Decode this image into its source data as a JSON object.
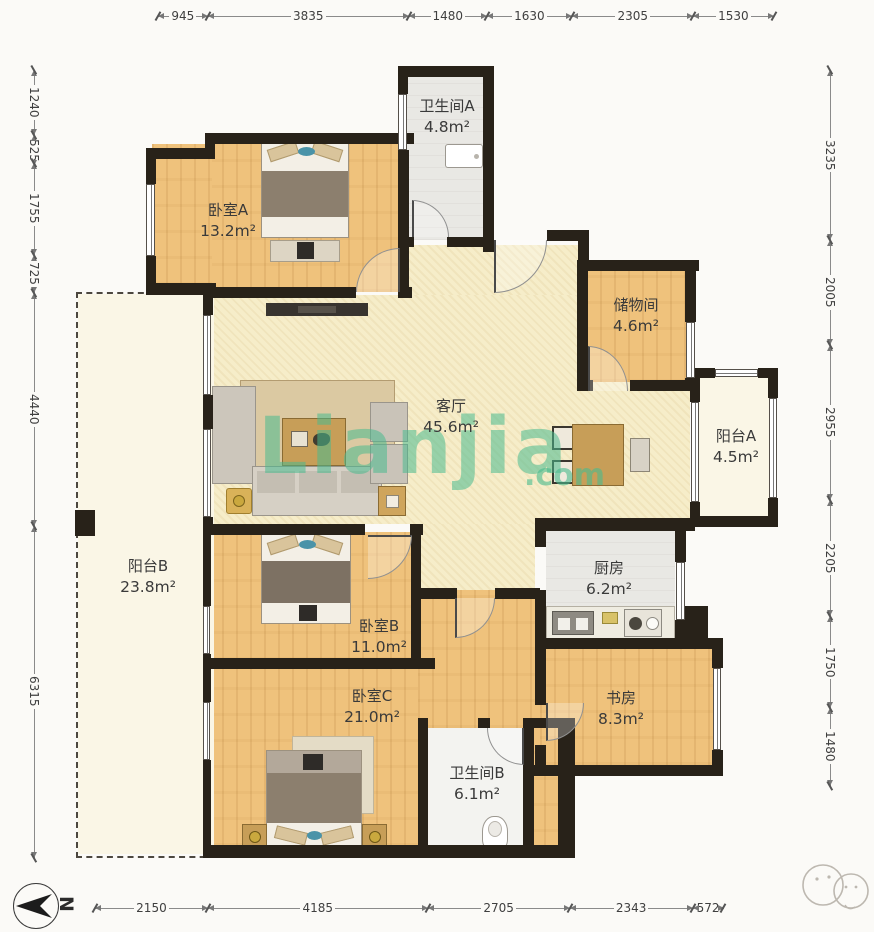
{
  "rooms": [
    {
      "id": "bedroom-a",
      "name": "卧室A",
      "area": "13.2m²"
    },
    {
      "id": "bathroom-a",
      "name": "卫生间A",
      "area": "4.8m²"
    },
    {
      "id": "storage",
      "name": "储物间",
      "area": "4.6m²"
    },
    {
      "id": "living-room",
      "name": "客厅",
      "area": "45.6m²"
    },
    {
      "id": "balcony-a",
      "name": "阳台A",
      "area": "4.5m²"
    },
    {
      "id": "balcony-b",
      "name": "阳台B",
      "area": "23.8m²"
    },
    {
      "id": "kitchen",
      "name": "厨房",
      "area": "6.2m²"
    },
    {
      "id": "bedroom-b",
      "name": "卧室B",
      "area": "11.0m²"
    },
    {
      "id": "bedroom-c",
      "name": "卧室C",
      "area": "21.0m²"
    },
    {
      "id": "study",
      "name": "书房",
      "area": "8.3m²"
    },
    {
      "id": "bathroom-b",
      "name": "卫生间B",
      "area": "6.1m²"
    }
  ],
  "dimensions_mm": {
    "top": [
      945,
      3835,
      1480,
      1630,
      2305,
      1530
    ],
    "left": [
      1240,
      525,
      1755,
      725,
      4440,
      6315
    ],
    "right": [
      3235,
      2005,
      2955,
      2205,
      1750,
      1480
    ],
    "bottom": [
      2150,
      4185,
      2705,
      2343,
      572
    ]
  },
  "compass": {
    "label": "N"
  },
  "watermark": {
    "text": "Lianjia",
    "suffix": ".com",
    "color": "#48ba8e"
  },
  "colors": {
    "wall": "#282219",
    "wood_floor": "#efc27c",
    "living_floor": "#f6edc9",
    "tile_floor": "#e9e8e4",
    "balcony_floor": "#faf6e6",
    "dimension_text": "#3f3f3f"
  }
}
